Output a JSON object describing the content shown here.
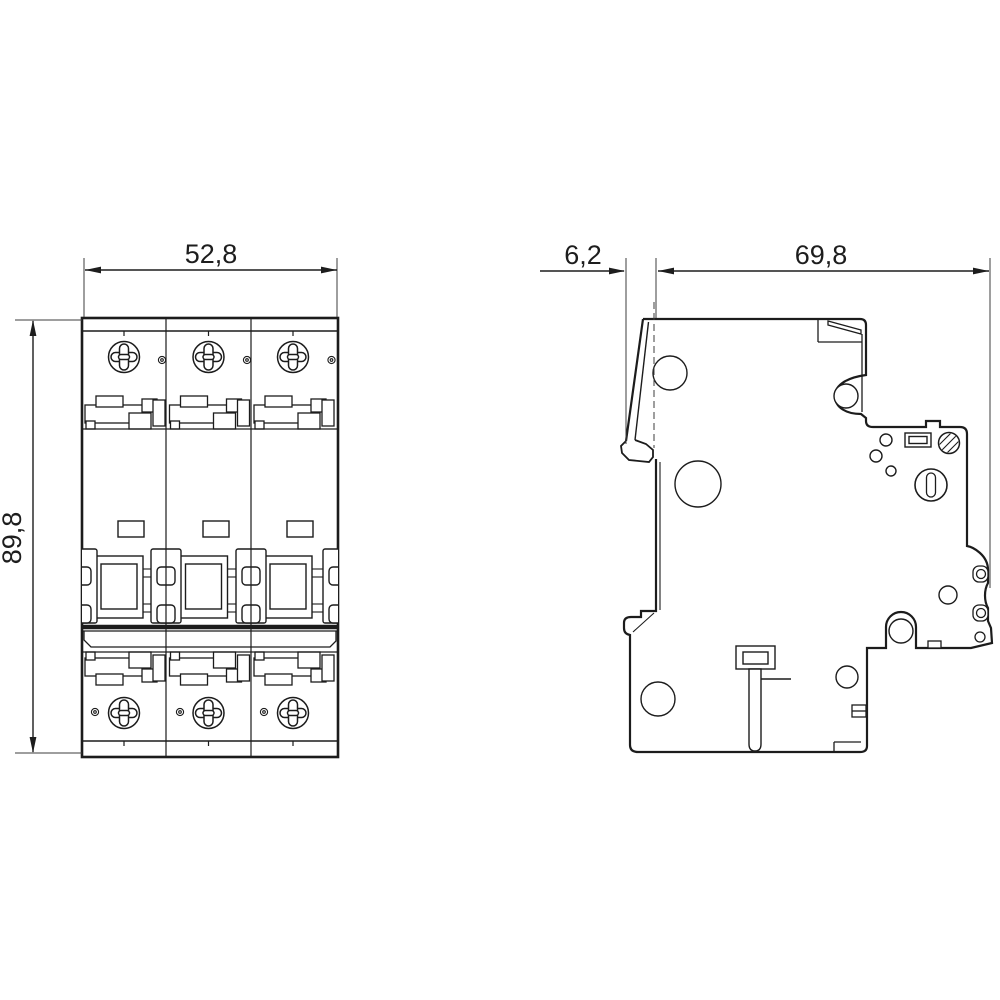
{
  "drawing": {
    "kind": "technical-dimension-drawing",
    "subject": "3-pole miniature circuit breaker, front view and side view",
    "background": "#ffffff",
    "line_color": "#1c1c1c",
    "thin_line_color": "#3c3c3c",
    "views": {
      "front": {
        "name": "front-view",
        "width": {
          "value": "52,8"
        },
        "height": {
          "value": "89,8"
        }
      },
      "side": {
        "name": "side-view",
        "clip_offset": {
          "value": "6,2"
        },
        "depth": {
          "value": "69,8"
        }
      }
    }
  }
}
